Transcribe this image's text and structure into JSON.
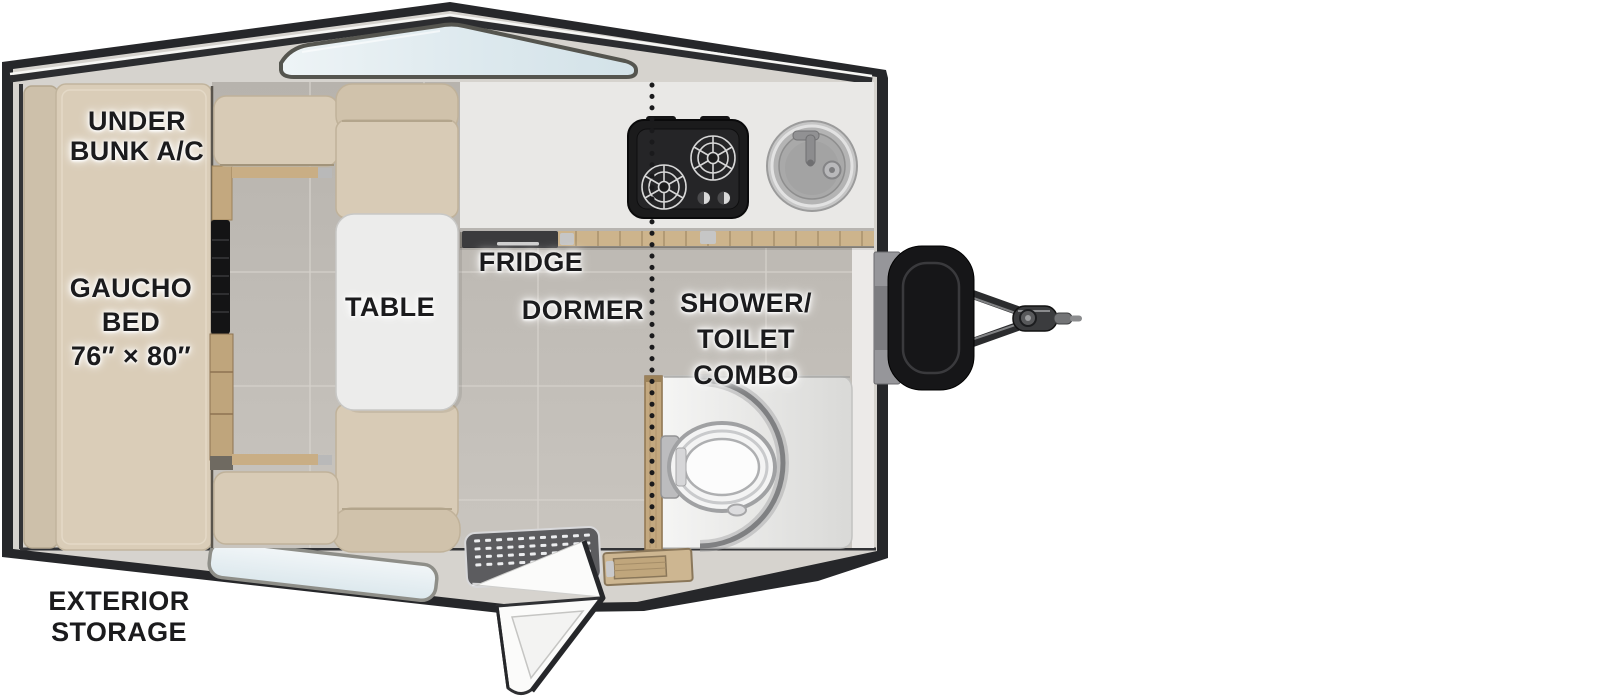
{
  "labels": {
    "under_bunk_ac_line1": "UNDER",
    "under_bunk_ac_line2": "BUNK A/C",
    "gaucho_bed_line1": "GAUCHO",
    "gaucho_bed_line2": "BED",
    "gaucho_bed_line3": "76″ × 80″",
    "table": "TABLE",
    "fridge": "FRIDGE",
    "dormer": "DORMER",
    "shower_toilet_line1": "SHOWER/",
    "shower_toilet_line2": "TOILET",
    "shower_toilet_line3": "COMBO",
    "exterior_storage_line1": "EXTERIOR",
    "exterior_storage_line2": "STORAGE"
  },
  "fixtures": [
    "gaucho-bed",
    "dinette-table",
    "dinette-benches",
    "two-burner-cooktop",
    "round-sink",
    "fridge-slot",
    "shower-toilet-combo",
    "toilet",
    "shower-mat",
    "entry-step-mat",
    "entry-door-open",
    "roof-peak-window",
    "lower-wall-window",
    "dormer-dotted-line",
    "wall-mounted-tv",
    "side-cabinet-drawers",
    "trailer-tongue-hitch",
    "propane-tank-cover"
  ],
  "colors": {
    "shell_dark": "#26272a",
    "body_panel": "#d6d3ce",
    "cushion": "#d8cbb6",
    "cushion_shaded": "#d0c2ab",
    "mattress": "#dacdb8",
    "floor_tile": "#bfbbb5",
    "counter": "#e9e8e6",
    "table_white": "#ececeb",
    "window_glass": "#dde9ee",
    "wood": "#c3a87f",
    "stove_black": "#1b1b1c",
    "steel_gray": "#a9a9ab",
    "shower_white": "#f2f2f1",
    "label_text": "#1b1b1d"
  }
}
